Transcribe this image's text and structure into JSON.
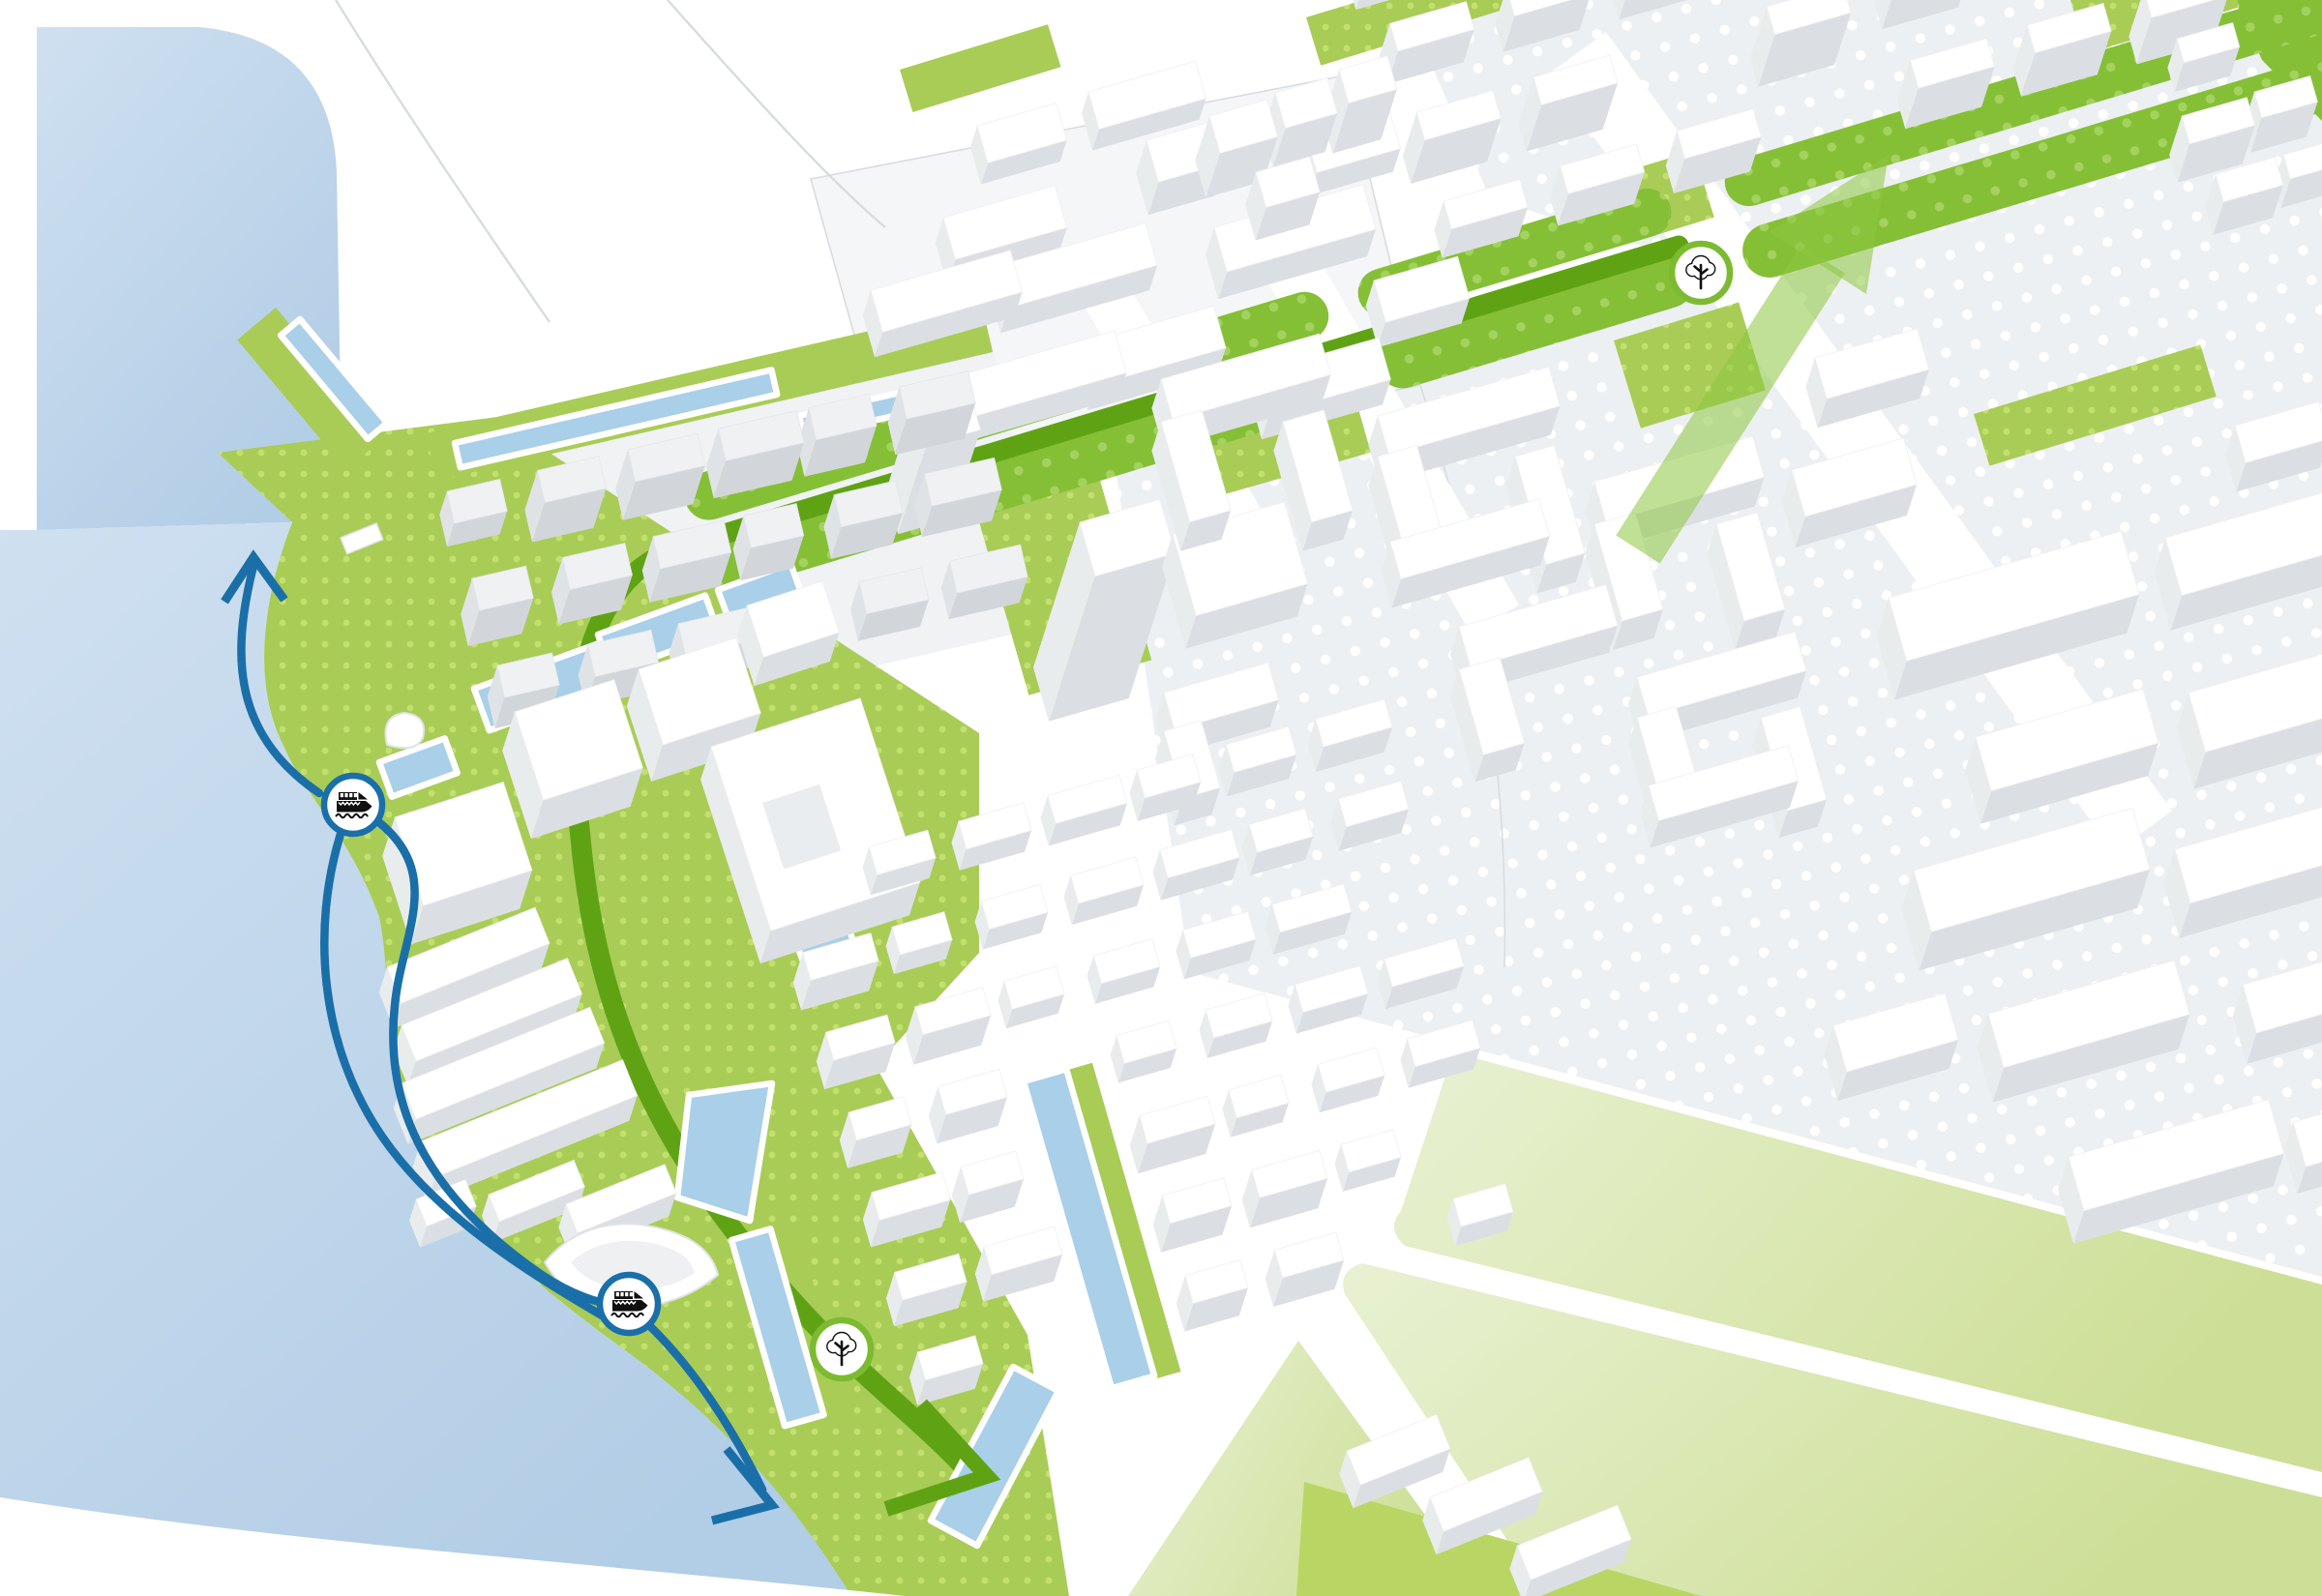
{
  "app": {
    "name": "city-masterplan-3d-map",
    "type": "urban planning visualization, axonometric city model"
  },
  "colors": {
    "water": "#c7dcee",
    "water_deep": "#b2cde6",
    "canal": "#a9cfe9",
    "park": "#a9cc57",
    "park_dot": "#c3e06f",
    "median": "#85bf36",
    "median_dot": "#a3d25e",
    "route_green": "#5fa315",
    "route_green_arrow": "#8dc63f",
    "route_blue": "#1a6fa9",
    "icon_green": "#7cbb31",
    "wedge_light": "#e6f0cf",
    "wedge_mid": "#cfe29b",
    "wedge_bright": "#b9d664",
    "ground": "#edf0f2",
    "ground_dot": "#ffffff",
    "building_top": "#ffffff",
    "building_side": "#dbdfe3",
    "building_side_light": "#e9eced",
    "building_grey_top": "#f0f1f3",
    "building_grey_side": "#d2d6da",
    "pad": "#f4f6f8",
    "road_edge": "#d8dcdf",
    "icon_glyph": "#101010",
    "white": "#ffffff"
  },
  "legend_markers": [
    {
      "id": "ferry-stop-north",
      "type": "ferry",
      "icon": "ferry-icon"
    },
    {
      "id": "ferry-stop-south",
      "type": "ferry",
      "icon": "ferry-icon"
    },
    {
      "id": "tree-route-park",
      "type": "tree",
      "icon": "tree-icon"
    },
    {
      "id": "tree-route-boulevard",
      "type": "tree",
      "icon": "tree-icon"
    }
  ],
  "routes": [
    {
      "id": "waterfront-ferry-route",
      "color_key": "route_blue",
      "style": "curved line with arrowheads along the harbor"
    },
    {
      "id": "green-corridor-route",
      "color_key": "route_green",
      "style": "line with chevron arrowheads, from boulevard through the park to the quay"
    }
  ]
}
